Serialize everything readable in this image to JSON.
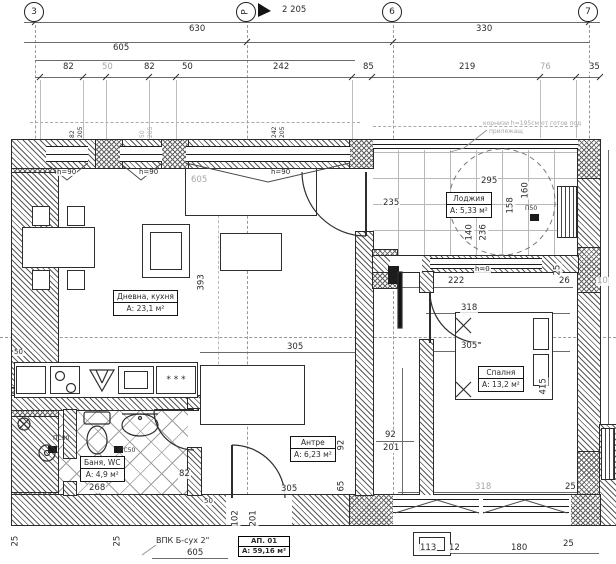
{
  "axes": {
    "b3": "3",
    "bR": "Р",
    "b6": "6",
    "b7": "7"
  },
  "dims": {
    "total": "2 205",
    "d630": "630",
    "d330": "330",
    "d605": "605",
    "seg": [
      "82",
      "50",
      "82",
      "50",
      "242",
      "85",
      "219",
      "76",
      "35"
    ],
    "win1w": "82",
    "win1h": "205",
    "win2w": "50",
    "win2h": "205",
    "win3w": "242",
    "win3h": "205",
    "h90": "h=90",
    "h0": "h=0",
    "p50": "П50",
    "liv_w": "305",
    "liv_h": "393",
    "liv_gray": "605",
    "left50": "50",
    "log295": "295",
    "log235": "235",
    "log158": "158",
    "log160": "160",
    "log140": "140",
    "log236": "236",
    "log222": "222",
    "log25": "25",
    "log26": "26",
    "log10": "10",
    "bed318": "318",
    "bed305": "305",
    "bed415": "415",
    "hall92a": "92",
    "hall92b": "92",
    "hall201": "201",
    "hall65": "65",
    "hall305": "305",
    "hall50": "50",
    "v102": "102",
    "v201": "201",
    "bath268": "268",
    "bath82": "82",
    "ps50": "ПС50",
    "bot318": "318",
    "bot25a": "25",
    "bot113": "113",
    "bot12": "12",
    "bot180": "180",
    "bot25b": "25",
    "bl25": "25"
  },
  "rooms": {
    "living": {
      "name": "Дневна, кухня",
      "area": "А: 23,1 м²"
    },
    "loggia": {
      "name": "Лоджия",
      "area": "А: 5,33 м²"
    },
    "bedroom": {
      "name": "Спалня",
      "area": "А: 13,2 м²"
    },
    "hall": {
      "name": "Антре",
      "area": "А: 6,23 м²"
    },
    "bath": {
      "name": "Баня, WC",
      "area": "А: 4,9 м²"
    }
  },
  "apartment": {
    "label": "АП. 01",
    "area": "А: 59,16 м²"
  },
  "notes": {
    "vpk": "ВПК Б-сух 2\"",
    "vpk_dim": "605",
    "cornice1": "корнизи h=195см от готов под",
    "cornice2": "прилежащ",
    "fridge": "* * *"
  }
}
